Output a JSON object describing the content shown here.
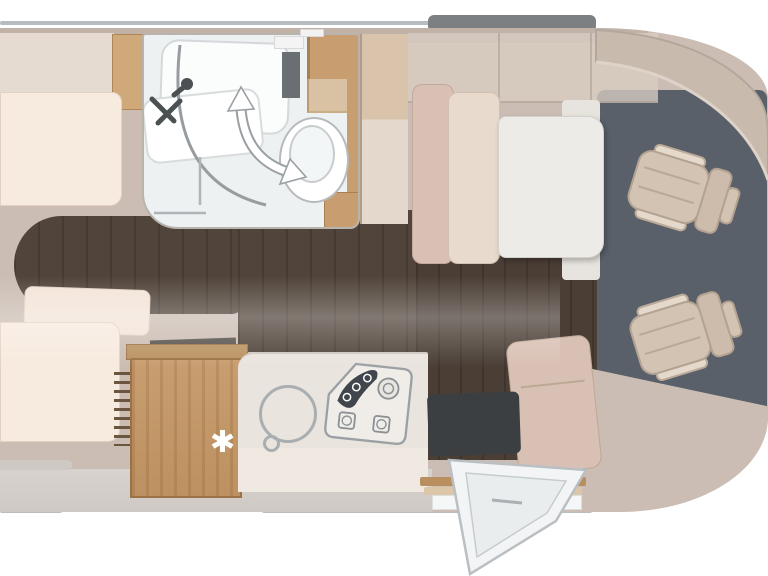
{
  "scene": {
    "type": "motorhome-floorplan-top-view",
    "rooms": [
      "rear-twin-beds",
      "bathroom",
      "wardrobe",
      "kitchen",
      "dinette",
      "cab"
    ]
  },
  "fridge": {
    "stars": [
      "✱",
      "✱",
      "✱"
    ]
  },
  "icons": {
    "shower-faucet-icon": "svg-shape",
    "swivel-arrow-icon": "curved-double-arrow",
    "freezer-star-icon": "✱",
    "sink-icon": "circle-ring",
    "hob-burners-icon": "svg-shape",
    "entry-door-icon": "open-door-triangle"
  },
  "colors": {
    "white": "#ffffff",
    "body": "#cbbdb3",
    "wallTop": "#c1b2a8",
    "lineGray": "#b7bcbe",
    "roofBar": "#7c8082",
    "floorWood": "#51453b",
    "floorWood2": "#4a3e35",
    "slate": "#59606a",
    "cream": "#f7eadf",
    "creamBorder": "#e3d2c2",
    "lockerBeige": "#e6dbd1",
    "wood": "#c89e70",
    "woodDark": "#9c7244",
    "woodLight": "#d0a97b",
    "woodBeige": "#d9c3ab",
    "ladderRung": "#6b5440",
    "counter": "#e9e4dd",
    "bottomWall": "#d8d3cf",
    "bathFloor": "#eef1f2",
    "bathWall": "#b9b3ae",
    "fixture": "#a9aeb1",
    "fixture2": "#b5babd",
    "iconDark": "#4b5053",
    "benchBack": "#d9c0b4",
    "benchSeat": "#e8dacd",
    "table": "#edebe8",
    "mat": "#3b3f42",
    "seat": "#d3c3b3",
    "seatBorder": "#b3a291",
    "armrest": "#e4d9cb",
    "dash": "#c9baae",
    "hobDark": "#41464c",
    "doorFill": "#f2f4f5",
    "doorStroke": "#b9bfc2"
  }
}
